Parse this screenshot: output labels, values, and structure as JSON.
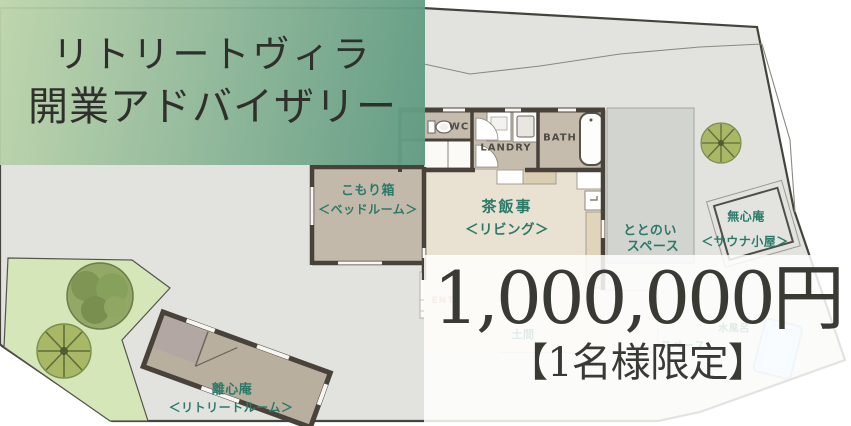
{
  "banner": {
    "line1": "リトリートヴィラ",
    "line2": "開業アドバイザリー"
  },
  "offer": {
    "price": "1,000,000円",
    "limit": "【1名様限定】"
  },
  "plan": {
    "rooms": {
      "bedroom": {
        "name": "こもり箱",
        "type": "＜ベッドルーム＞"
      },
      "living": {
        "name": "茶飯事",
        "type": "＜リビング＞"
      },
      "totonoi": {
        "name": "ととのい",
        "type": "スペース"
      },
      "sauna": {
        "name": "無心庵",
        "type": "＜サウナ小屋＞"
      },
      "retreat": {
        "name": "離心庵",
        "type": "＜リトリートルーム＞"
      }
    },
    "fixtures": {
      "wc": "WC",
      "laundry": "LANDRY",
      "bath": "BATH",
      "entrance": "ENT"
    },
    "faint_labels": {
      "doma": "土間",
      "space": "スペース",
      "cold_bath": "水風呂"
    },
    "colors": {
      "label_teal": "#2b7a69",
      "banner_green_left": "#bdd5ab",
      "banner_green_right": "#5f9a82",
      "site_gray": "#e2e3df",
      "garden_green": "#d5e6b8",
      "wall_dark": "#49423a",
      "entrance_salmon": "#d98f75",
      "price_text": "#3a3a35"
    }
  }
}
